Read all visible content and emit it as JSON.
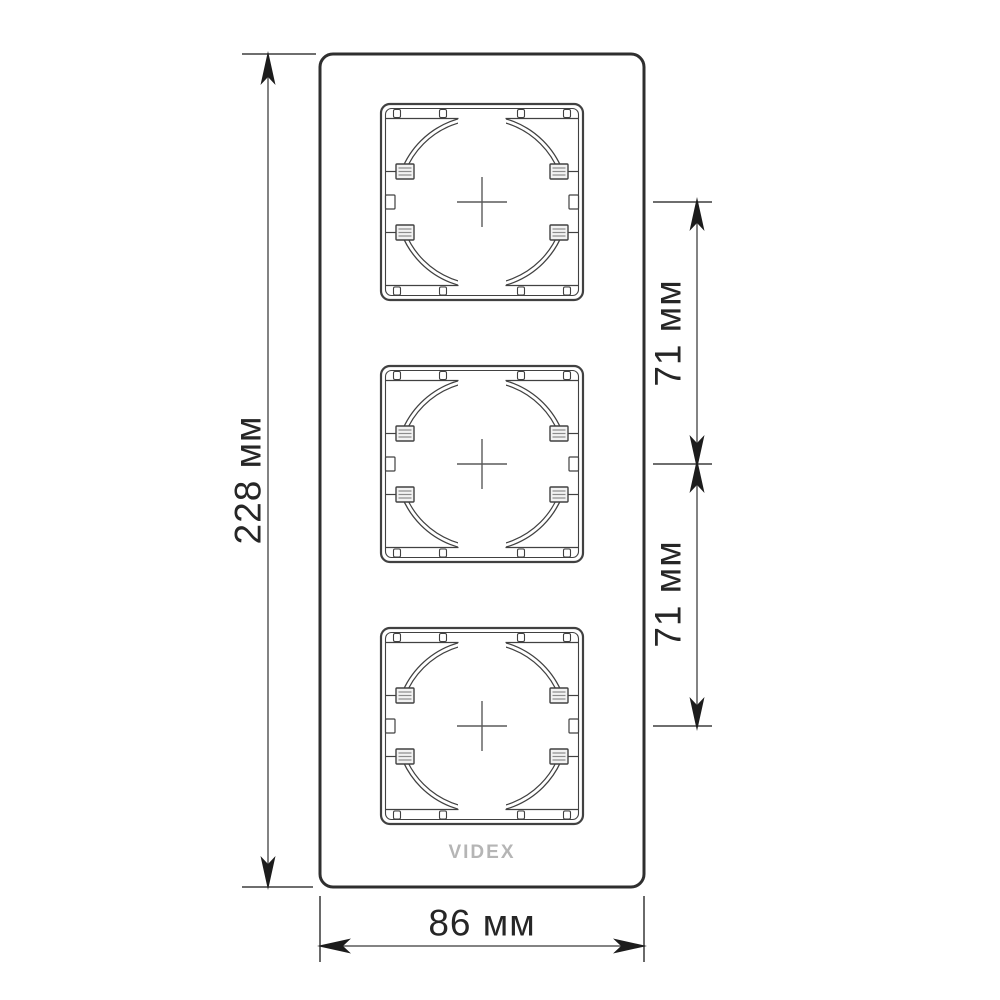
{
  "labels": {
    "height": "228 мм",
    "spacing_upper": "71 мм",
    "spacing_lower": "71 мм",
    "width": "86 мм"
  },
  "brand": {
    "logo_text": "VIDEX"
  },
  "colors": {
    "background": "#ffffff",
    "frame_line": "#2f2f2f",
    "drawing_line": "#414141",
    "dimension_line": "#5a5a5a",
    "arrow": "#1c1c1c",
    "label_text": "#262626",
    "logo": "#b5b5b5",
    "clip_fill": "#f2f2f2",
    "clip_rib": "#8c8c8c"
  }
}
